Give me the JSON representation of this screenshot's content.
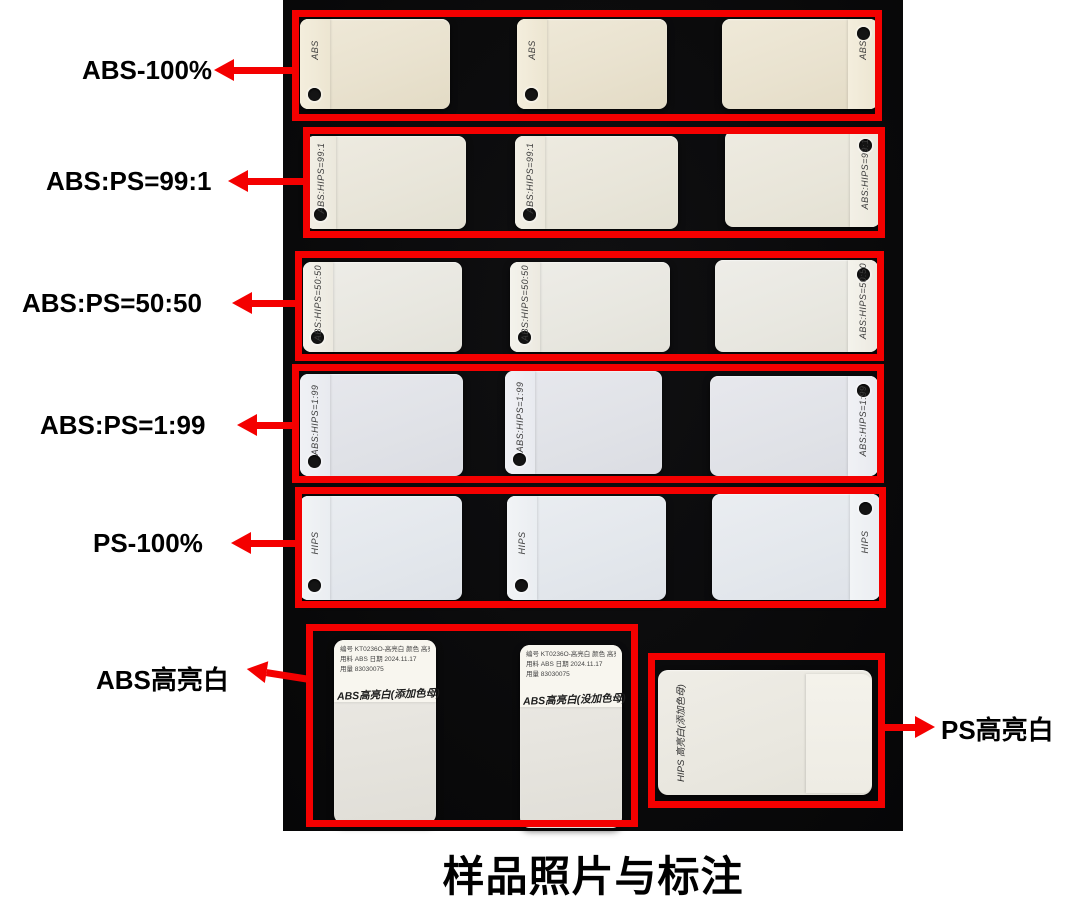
{
  "colors": {
    "accent_red": "#f40000",
    "photo_background": "#0a0a0b",
    "page_background": "#ffffff",
    "chip_row1_tint": "#e9e2cf",
    "chip_row2_tint": "#e8e5d9",
    "chip_row3_tint": "#e8e7e0",
    "chip_row4_tint": "#e0e2e7",
    "chip_row5_tint": "#e3e7ec"
  },
  "caption": "样品照片与标注",
  "row_groups": [
    {
      "label": "ABS-100%",
      "chip_texts": [
        "ABS",
        "ABS",
        "ABS"
      ]
    },
    {
      "label": "ABS:PS=99:1",
      "chip_texts": [
        "ABS:HIPS=99:1",
        "ABS:HIPS=99:1",
        "ABS:HIPS=99:1"
      ]
    },
    {
      "label": "ABS:PS=50:50",
      "chip_texts": [
        "ABS:HIPS=50:50",
        "ABS:HIPS=50:50",
        "ABS:HIPS=50:50"
      ]
    },
    {
      "label": "ABS:PS=1:99",
      "chip_texts": [
        "ABS:HIPS=1:99",
        "ABS:HIPS=1:99",
        "ABS:HIPS=1:99"
      ]
    },
    {
      "label": "PS-100%",
      "chip_texts": [
        "HIPS",
        "HIPS",
        "HIPS"
      ]
    }
  ],
  "bottom_left": {
    "label": "ABS高亮白",
    "chips": [
      {
        "sticker_line1": "编号 KT0236O-高亮白  颜色 高亮白",
        "sticker_line2": "用料 ABS   日期 2024.11.17",
        "sticker_line3": "用量        83030075",
        "handwriting": "ABS高亮白(添加色母)"
      },
      {
        "sticker_line1": "编号 KT0236O-高亮白  颜色 高亮白",
        "sticker_line2": "用料 ABS   日期 2024.11.17",
        "sticker_line3": "用量        83030075",
        "handwriting": "ABS高亮白(没加色母)"
      }
    ]
  },
  "bottom_right": {
    "label": "PS高亮白",
    "chip_handwriting": "HIPS 高亮白(添加色母)"
  }
}
